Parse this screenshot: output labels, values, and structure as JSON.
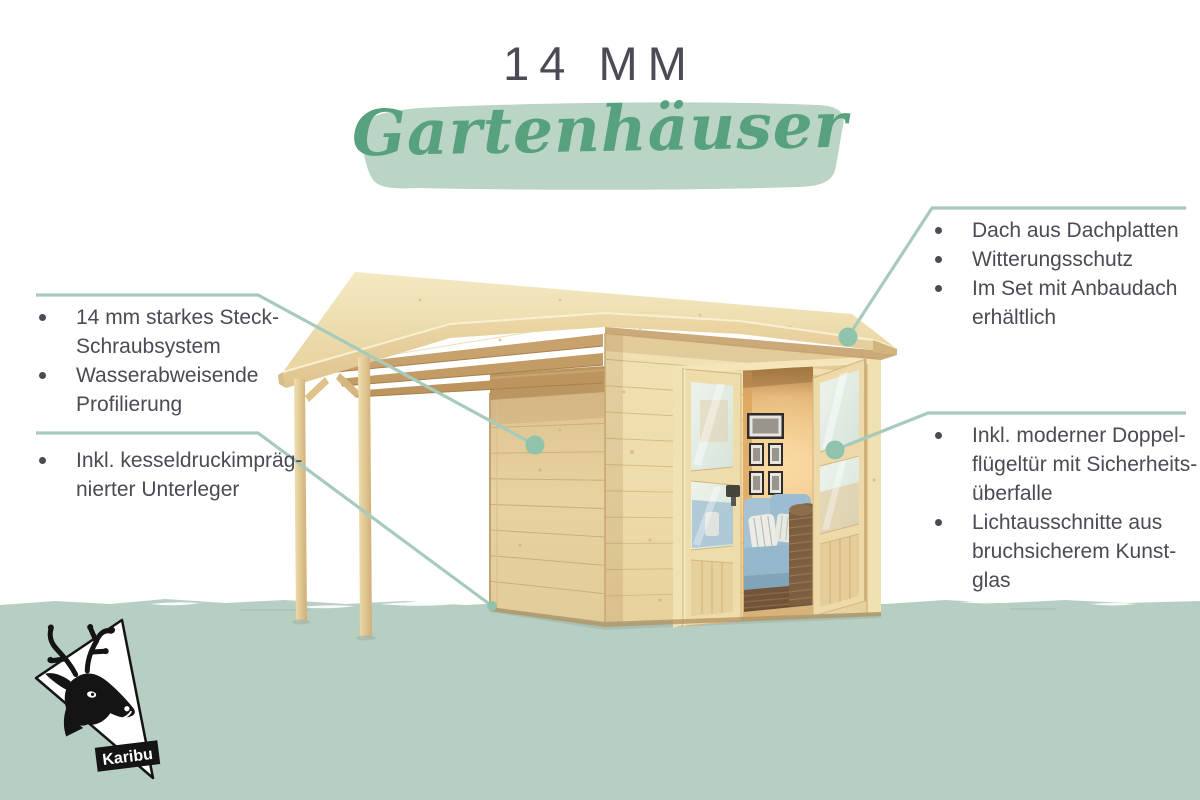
{
  "title": "14 MM",
  "subtitle": "Gartenhäuser",
  "logo": {
    "text": "Karibu"
  },
  "callouts": {
    "left_top": {
      "items": [
        {
          "lines": [
            "14 mm starkes Steck-",
            "Schraubsystem"
          ]
        },
        {
          "lines": [
            "Wasserabweisende",
            "Profilierung"
          ]
        }
      ]
    },
    "left_bottom": {
      "items": [
        {
          "lines": [
            "Inkl. kesseldruckimpräg-",
            "nierter Unterleger"
          ]
        }
      ]
    },
    "right_top": {
      "items": [
        {
          "lines": [
            "Dach aus Dachplatten"
          ]
        },
        {
          "lines": [
            "Witterungsschutz"
          ]
        },
        {
          "lines": [
            "Im Set mit Anbaudach",
            "erhältlich"
          ]
        }
      ]
    },
    "right_bottom": {
      "items": [
        {
          "lines": [
            "Inkl. moderner Doppel-",
            "flügeltür mit Sicherheits-",
            "überfalle"
          ]
        },
        {
          "lines": [
            "Lichtausschnitte aus",
            "bruchsicherem Kunst-",
            "glas"
          ]
        }
      ]
    }
  },
  "colors": {
    "ink": "#4b4a55",
    "line_green": "#a6cbbc",
    "dot_green": "#8fc3ab",
    "band_green": "#b7cfc3",
    "brush_green": "#bad4c6",
    "script_green": "#57a17e",
    "logo_black": "#141414"
  }
}
